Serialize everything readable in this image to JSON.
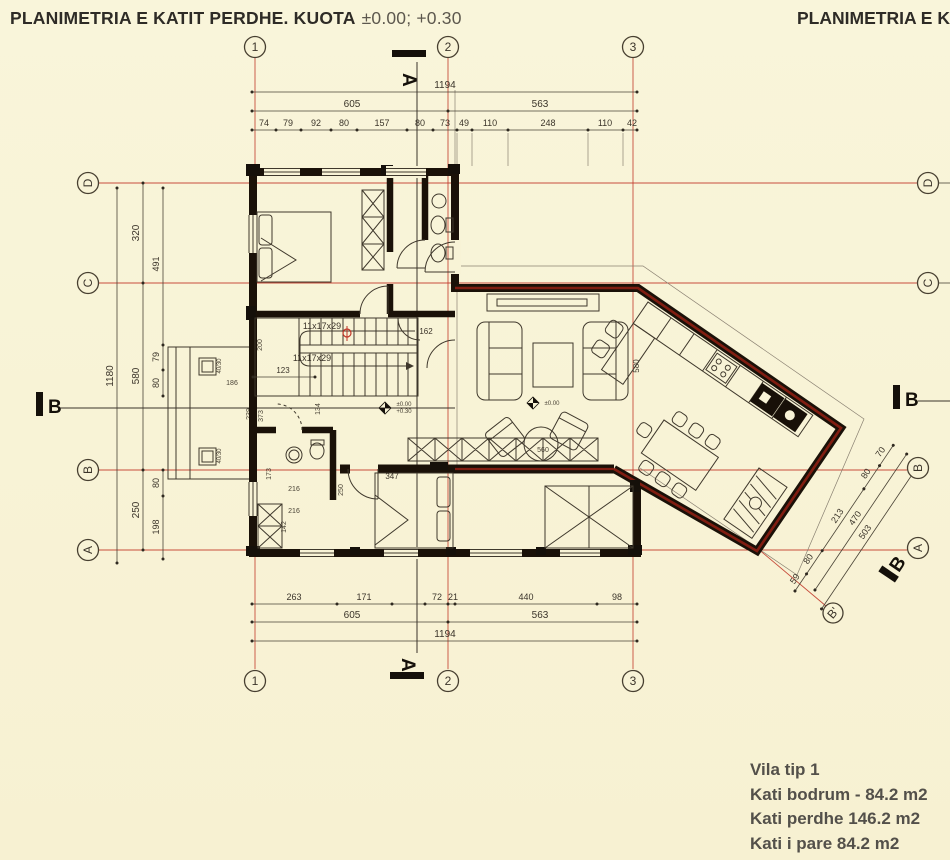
{
  "colors": {
    "paper": "#f8f3d6",
    "grid_red": "#c03527",
    "wall_dark": "#1a1108",
    "wall_red": "#801d11",
    "ink": "#3b342a"
  },
  "header": {
    "title_main": "PLANIMETRIA E KATIT PERDHE. KUOTA",
    "title_levels": "±0.00; +0.30",
    "title_right": "PLANIMETRIA E K"
  },
  "grid": {
    "col1": "1",
    "col2": "2",
    "col3": "3",
    "rowD": "D",
    "rowC": "C",
    "rowB": "B",
    "rowA": "A",
    "b_prime": "B'"
  },
  "sections": {
    "a": "A",
    "b": "B"
  },
  "dims": {
    "top": {
      "total": "1194",
      "left": "605",
      "right": "563",
      "chain": [
        "74",
        "79",
        "92",
        "80",
        "157",
        "80",
        "73",
        "49",
        "110",
        "248",
        "110",
        "42"
      ]
    },
    "bottom": {
      "total": "1194",
      "left": "605",
      "right": "563",
      "chain": [
        "263",
        "171",
        "72",
        "21",
        "440",
        "98"
      ]
    },
    "left": {
      "total": "1180",
      "spans": [
        "320",
        "580",
        "250"
      ],
      "upper": [
        "491",
        "79",
        "80"
      ],
      "lower": [
        "80",
        "198"
      ]
    },
    "right": {
      "chain": [
        "59",
        "80",
        "213",
        "80",
        "70"
      ],
      "inner": "470",
      "outer": "503"
    }
  },
  "plan": {
    "stairs_label": "11x17x29",
    "stairs_width": "123",
    "niche": "162",
    "hall_depth": "200",
    "hall_width": "134",
    "bath_door": "216",
    "bath_door2": "216",
    "bath_w": "142",
    "bath_h": "173",
    "bed_door": "250",
    "bed_width": "347",
    "living_depth": "580",
    "sofa": "560",
    "terrace": {
      "w": "186",
      "d1": "239",
      "d2": "373",
      "column": "40/30"
    },
    "levels": {
      "zero": "±0.00",
      "entry": "+0.30"
    }
  },
  "legend": {
    "l1": "Vila tip 1",
    "l2": "Kati bodrum - 84.2 m2",
    "l3": "Kati perdhe 146.2 m2",
    "l4": "Kati i pare 84.2 m2"
  }
}
